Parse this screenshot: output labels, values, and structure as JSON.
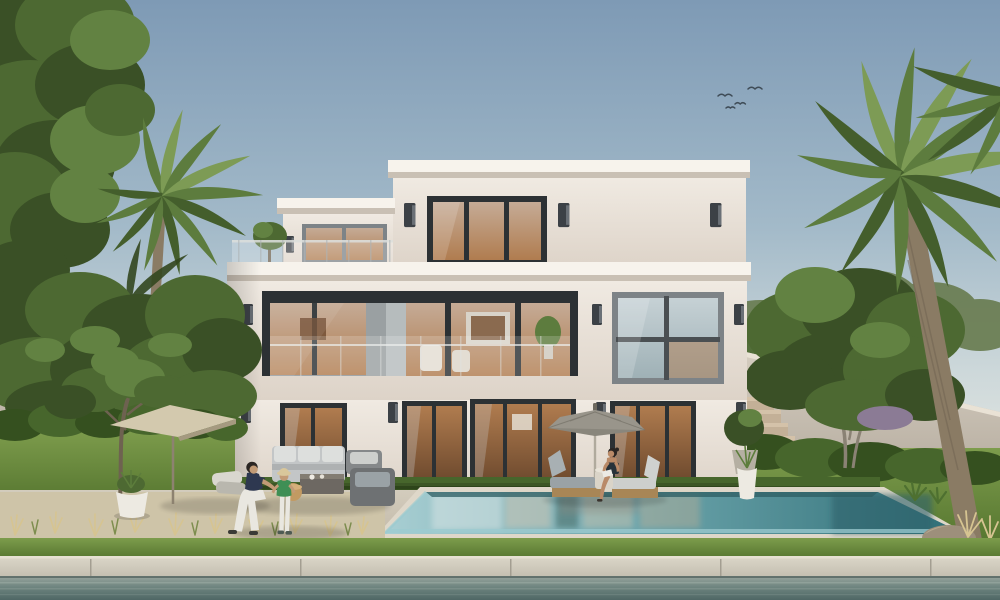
{
  "scene": {
    "label": "Daylight 3D architectural rendering of a modern three-storey white villa with roof terrace, glass balcony, swimming pool, palm trees, garden walls, parasols and people by the pool",
    "objects": [
      "sky",
      "flying-birds",
      "leafy-tree-left",
      "palm-tree-left",
      "garden-wall-left",
      "garden-wall-right",
      "stone-stairs",
      "frangipani-tree-right",
      "palm-tree-right",
      "villa-building",
      "roof-terrace-railing",
      "balcony-glass-railing",
      "wall-sconces",
      "glass-doors",
      "patio-lounge-set",
      "cantilever-parasol-left",
      "pool-parasol-right",
      "sun-loungers",
      "man-crouching",
      "child-standing",
      "woman-sitting",
      "swimming-pool",
      "white-planter",
      "potted-plants",
      "boulder",
      "ornamental-grasses",
      "lawn",
      "pool-deck",
      "stone-promenade",
      "waterway"
    ]
  },
  "colors": {
    "sky_top": "#7e9ab5",
    "sky_mid": "#a3bac9",
    "sky_low": "#cdd8da",
    "sky_horizon": "#e6e8e3",
    "bird": "#3f4c57",
    "wall": "#f0eae2",
    "wall_shade": "#ddd3c8",
    "cornice": "#f7f3ec",
    "cornice_shadow": "#c9c0b4",
    "frame_dark": "#2c3134",
    "frame_gray": "#7d8387",
    "sconce": "#3c4146",
    "glass_cool_top": "#c6d1d5",
    "glass_cool_bot": "#9fb1b6",
    "glass_warm": "#c5ab96",
    "interior_amber": "#b07c4f",
    "interior_dark": "#6e4a2e",
    "recess": "#8d9498",
    "pillar_gray": "#9aa0a2",
    "foliage_dark": "#3a5026",
    "foliage_mid": "#4d6932",
    "foliage_light": "#628242",
    "foliage_back": "#6c7f55",
    "hedge_dark": "#35501f",
    "hedge_mid": "#47662c",
    "palm_dark": "#445e2c",
    "palm_mid": "#5d7c3e",
    "palm_light": "#7d9b55",
    "palm_silhouette": "#33471f",
    "trunk": "#8a7b64",
    "trunk_dark": "#6e6250",
    "lawn_light": "#7d9c4c",
    "lawn_dark": "#55752f",
    "deck": "#d3ccbd",
    "deck_dark": "#c0b7a6",
    "wild_bed": "#cec4a8",
    "dry_grass": "#d6c491",
    "garden_wall": "#d5cdc0",
    "garden_wall_dark": "#b7aea1",
    "step_face": "#c3b097",
    "step_top": "#d4c2a9",
    "coping": "#ded7c9",
    "pool_light": "#a9cfd3",
    "pool_mid": "#6ba4ab",
    "pool_dark": "#2f6e76",
    "waterline": "#2e5d63",
    "tile": "#9ccbd0",
    "canal_top": "#97a49d",
    "canal_mid": "#6b827d",
    "canal_bot": "#4f6765",
    "stone": "#c2bdaf",
    "stone_light": "#dcd7c9",
    "stone_joint": "#a39e91",
    "umbrella_left": "#d3c9ae",
    "umbrella_left_under": "#a59a80",
    "umbrella_right": "#99958b",
    "umbrella_right_dark": "#6e6a60",
    "umbrella_pole": "#b0aa9d",
    "sofa": "#c3c6c7",
    "sofa_light": "#dddfdd",
    "chair_dark": "#6e7173",
    "table_dark": "#6d6862",
    "teak": "#a88656",
    "cushion_gray": "#9aa2a6",
    "cushion_light": "#cdcfcd",
    "basket": "#c29a62",
    "skin": "#c29b76",
    "skin_tan": "#b98a68",
    "hair_dark": "#2b2623",
    "shirt_navy": "#2e3850",
    "white_cloth": "#e9e7e0",
    "shirt_green": "#3f8f55",
    "hat": "#d9c79b",
    "swimsuit": "#27323a",
    "book": "#eceae4",
    "rock": "#9d8f7b",
    "rock_light": "#b6a890",
    "pot_white": "#edeae2",
    "pot_gray": "#b5afa2",
    "purple_bush": "#8b7b95"
  }
}
